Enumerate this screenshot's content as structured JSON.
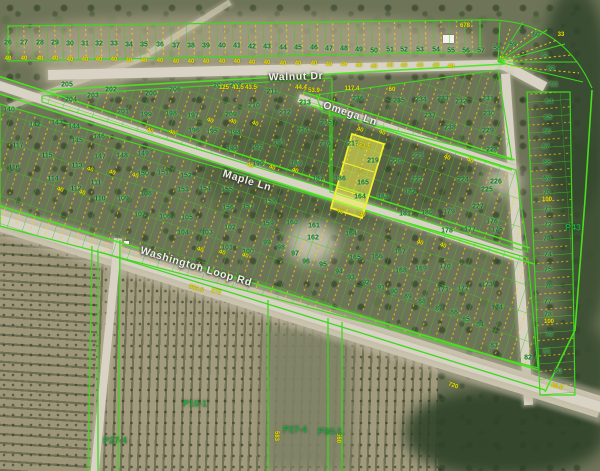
{
  "map": {
    "title": "Parcel map with aerial imagery",
    "colors": {
      "parcel_line_green": "#37cc1a",
      "survey_line_yellow": "#e4dc00",
      "lot_number_green": "#0b6e2c",
      "dimension_yellow": "#e9e100",
      "highlight_fill": "#f4ee3c",
      "road_tan": "#d8d3c4"
    },
    "highlight": {
      "parcel_labels": [
        "219",
        "165",
        "164"
      ],
      "fill": "#f4ee3c"
    },
    "streets": [
      [
        "Walnut Dr",
        296,
        77,
        -1.5
      ],
      [
        "Omega Ln",
        350,
        114,
        18.5
      ],
      [
        "Maple Ln",
        247,
        181,
        17
      ],
      [
        "Washington Loop Rd",
        196,
        267,
        16.5
      ]
    ],
    "parcels": [
      [
        "P10-1",
        195,
        404,
        0
      ],
      [
        "P27-4",
        295,
        430,
        0
      ],
      [
        "P34-1",
        330,
        432,
        0
      ],
      [
        "P27-4",
        115,
        441,
        0
      ],
      [
        "P43",
        573,
        228,
        0
      ]
    ],
    "lots": [
      [
        "26",
        8,
        43
      ],
      [
        "27",
        24,
        43
      ],
      [
        "28",
        40,
        43
      ],
      [
        "29",
        55,
        43
      ],
      [
        "30",
        70,
        44
      ],
      [
        "31",
        85,
        44
      ],
      [
        "32",
        99,
        44
      ],
      [
        "33",
        114,
        44
      ],
      [
        "34",
        129,
        45
      ],
      [
        "35",
        144,
        45
      ],
      [
        "36",
        160,
        45
      ],
      [
        "37",
        176,
        46
      ],
      [
        "38",
        191,
        46
      ],
      [
        "39",
        206,
        46
      ],
      [
        "40",
        222,
        46
      ],
      [
        "41",
        237,
        46
      ],
      [
        "42",
        252,
        47
      ],
      [
        "43",
        267,
        47
      ],
      [
        "44",
        283,
        48
      ],
      [
        "45",
        298,
        48
      ],
      [
        "46",
        314,
        48
      ],
      [
        "47",
        329,
        49
      ],
      [
        "48",
        344,
        49
      ],
      [
        "49",
        359,
        50
      ],
      [
        "50",
        374,
        51
      ],
      [
        "51",
        390,
        50
      ],
      [
        "52",
        404,
        50
      ],
      [
        "53",
        420,
        50
      ],
      [
        "54",
        436,
        50
      ],
      [
        "55",
        451,
        51
      ],
      [
        "56",
        466,
        51
      ],
      [
        "57",
        481,
        51
      ],
      [
        "58",
        497,
        49
      ],
      [
        "59",
        513,
        45
      ],
      [
        "60",
        536,
        35
      ],
      [
        "61",
        545,
        56
      ],
      [
        "62",
        551,
        69
      ],
      [
        "63",
        554,
        85
      ],
      [
        "64",
        549,
        102
      ],
      [
        "65",
        548,
        118
      ],
      [
        "66",
        547,
        132
      ],
      [
        "67",
        546,
        147
      ],
      [
        "68",
        547,
        163
      ],
      [
        "69",
        547,
        179
      ],
      [
        "70",
        547,
        193
      ],
      [
        "71",
        548,
        210
      ],
      [
        "72",
        548,
        225
      ],
      [
        "73",
        547,
        239
      ],
      [
        "74",
        548,
        255
      ],
      [
        "75",
        548,
        270
      ],
      [
        "76",
        549,
        286
      ],
      [
        "77",
        548,
        302
      ],
      [
        "78",
        548,
        315
      ],
      [
        "79",
        549,
        335
      ],
      [
        "80",
        558,
        372
      ],
      [
        "81",
        547,
        352
      ],
      [
        "82",
        528,
        358
      ],
      [
        "83",
        494,
        346
      ],
      [
        "84",
        480,
        325
      ],
      [
        "85",
        466,
        320
      ],
      [
        "86",
        454,
        313
      ],
      [
        "87",
        439,
        309
      ],
      [
        "88",
        422,
        302
      ],
      [
        "89",
        408,
        297
      ],
      [
        "90",
        394,
        292
      ],
      [
        "91",
        381,
        288
      ],
      [
        "92",
        366,
        283
      ],
      [
        "93",
        351,
        278
      ],
      [
        "94",
        339,
        272
      ],
      [
        "95",
        323,
        265
      ],
      [
        "96",
        306,
        262
      ],
      [
        "97",
        295,
        254
      ],
      [
        "98",
        281,
        248
      ],
      [
        "99",
        267,
        243
      ],
      [
        "100",
        248,
        252
      ],
      [
        "101",
        227,
        248
      ],
      [
        "102",
        230,
        228
      ],
      [
        "103",
        207,
        233
      ],
      [
        "104",
        183,
        233
      ],
      [
        "105",
        187,
        218
      ],
      [
        "106",
        165,
        217
      ],
      [
        "107",
        140,
        215
      ],
      [
        "108",
        146,
        194
      ],
      [
        "109",
        123,
        199
      ],
      [
        "110",
        100,
        199
      ],
      [
        "111",
        96,
        183
      ],
      [
        "112",
        76,
        189
      ],
      [
        "113",
        77,
        166
      ],
      [
        "114",
        53,
        179
      ],
      [
        "115",
        47,
        156
      ],
      [
        "116",
        14,
        168
      ],
      [
        "117",
        18,
        146
      ],
      [
        "140",
        9,
        110
      ],
      [
        "142",
        35,
        125
      ],
      [
        "143",
        57,
        123
      ],
      [
        "144",
        74,
        127
      ],
      [
        "145",
        77,
        141
      ],
      [
        "146",
        99,
        137
      ],
      [
        "147",
        100,
        157
      ],
      [
        "148",
        122,
        156
      ],
      [
        "149",
        143,
        154
      ],
      [
        "150",
        143,
        174
      ],
      [
        "151",
        163,
        173
      ],
      [
        "152",
        186,
        176
      ],
      [
        "153",
        183,
        190
      ],
      [
        "154",
        205,
        189
      ],
      [
        "155",
        227,
        190
      ],
      [
        "156",
        228,
        208
      ],
      [
        "157",
        248,
        207
      ],
      [
        "158",
        270,
        202
      ],
      [
        "159",
        268,
        224
      ],
      [
        "160",
        292,
        223
      ],
      [
        "161",
        314,
        226
      ],
      [
        "162",
        313,
        238
      ],
      [
        "164",
        351,
        234
      ],
      [
        "165",
        355,
        258
      ],
      [
        "166",
        377,
        257
      ],
      [
        "167",
        400,
        252
      ],
      [
        "168",
        401,
        271
      ],
      [
        "169",
        421,
        269
      ],
      [
        "170",
        445,
        267
      ],
      [
        "171",
        443,
        290
      ],
      [
        "172",
        463,
        289
      ],
      [
        "173",
        487,
        285
      ],
      [
        "174",
        497,
        308
      ],
      [
        "175",
        497,
        230
      ],
      [
        "176",
        492,
        222
      ],
      [
        "177",
        470,
        230
      ],
      [
        "178",
        447,
        231
      ],
      [
        "179",
        449,
        212
      ],
      [
        "180",
        427,
        213
      ],
      [
        "181",
        405,
        214
      ],
      [
        "182",
        410,
        192
      ],
      [
        "183",
        383,
        197
      ],
      [
        "186",
        340,
        179
      ],
      [
        "187",
        318,
        179
      ],
      [
        "189",
        296,
        164
      ],
      [
        "190",
        258,
        164
      ],
      [
        "191",
        279,
        143
      ],
      [
        "192",
        257,
        148
      ],
      [
        "193",
        232,
        149
      ],
      [
        "194",
        235,
        133
      ],
      [
        "195",
        212,
        132
      ],
      [
        "196",
        194,
        131
      ],
      [
        "197",
        193,
        116
      ],
      [
        "198",
        171,
        114
      ],
      [
        "199",
        146,
        115
      ],
      [
        "200",
        151,
        94
      ],
      [
        "201",
        123,
        112
      ],
      [
        "202",
        111,
        90
      ],
      [
        "203",
        93,
        96
      ],
      [
        "204",
        71,
        100
      ],
      [
        "205",
        67,
        85
      ],
      [
        "206",
        175,
        90
      ],
      [
        "207",
        219,
        86
      ],
      [
        "208",
        236,
        85
      ],
      [
        "209",
        231,
        115
      ],
      [
        "210",
        254,
        106
      ],
      [
        "211",
        272,
        92
      ],
      [
        "212",
        285,
        113
      ],
      [
        "213",
        305,
        103
      ],
      [
        "214",
        303,
        131
      ],
      [
        "215",
        326,
        123
      ],
      [
        "216",
        325,
        144
      ],
      [
        "217",
        353,
        144
      ],
      [
        "219",
        373,
        161
      ],
      [
        "165",
        363,
        183
      ],
      [
        "164",
        360,
        197
      ],
      [
        "220",
        396,
        162
      ],
      [
        "221",
        418,
        156
      ],
      [
        "222",
        417,
        180
      ],
      [
        "224",
        463,
        180
      ],
      [
        "225",
        487,
        190
      ],
      [
        "226",
        496,
        182
      ],
      [
        "227",
        478,
        207
      ],
      [
        "228",
        492,
        150
      ],
      [
        "229",
        488,
        131
      ],
      [
        "230",
        489,
        114
      ],
      [
        "231",
        488,
        99
      ],
      [
        "232",
        461,
        102
      ],
      [
        "233",
        443,
        99
      ],
      [
        "234",
        421,
        100
      ],
      [
        "235",
        399,
        101
      ],
      [
        "236",
        358,
        99
      ],
      [
        "237",
        430,
        116
      ],
      [
        "238",
        450,
        128
      ]
    ],
    "dims": [
      [
        "40",
        8,
        59
      ],
      [
        "40",
        24,
        59
      ],
      [
        "40",
        40,
        59
      ],
      [
        "40",
        55,
        59
      ],
      [
        "40",
        70,
        60
      ],
      [
        "40",
        85,
        60
      ],
      [
        "40",
        99,
        60
      ],
      [
        "40",
        114,
        60
      ],
      [
        "40",
        129,
        61
      ],
      [
        "40",
        144,
        61
      ],
      [
        "40",
        160,
        61
      ],
      [
        "40",
        176,
        62
      ],
      [
        "40",
        191,
        62
      ],
      [
        "40",
        206,
        62
      ],
      [
        "40",
        222,
        62
      ],
      [
        "40",
        237,
        62
      ],
      [
        "40",
        252,
        63
      ],
      [
        "40",
        267,
        63
      ],
      [
        "40",
        283,
        64
      ],
      [
        "40",
        298,
        64
      ],
      [
        "40",
        314,
        64
      ],
      [
        "40",
        329,
        65
      ],
      [
        "40",
        344,
        65
      ],
      [
        "40",
        359,
        66
      ],
      [
        "40",
        374,
        67
      ],
      [
        "40",
        390,
        66
      ],
      [
        "40",
        404,
        66
      ],
      [
        "40",
        420,
        66
      ],
      [
        "40",
        436,
        66
      ],
      [
        "40",
        451,
        67
      ],
      [
        "678",
        465,
        26
      ],
      [
        "100",
        547,
        200
      ],
      [
        "100",
        549,
        322
      ],
      [
        "121.5",
        363,
        146,
        18
      ],
      [
        "720",
        453,
        386,
        20
      ],
      [
        "85.8",
        557,
        387,
        15
      ],
      [
        "382.5",
        196,
        289,
        17
      ],
      [
        "273",
        216,
        292,
        17
      ],
      [
        "117.4",
        352,
        89
      ],
      [
        "60",
        392,
        90
      ],
      [
        "44.4",
        301,
        88
      ],
      [
        "53.9",
        314,
        91
      ],
      [
        "125",
        224,
        88
      ],
      [
        "41.5",
        238,
        88
      ],
      [
        "43.5",
        251,
        88
      ],
      [
        "583",
        276,
        436,
        90
      ],
      [
        "560",
        338,
        438,
        90
      ],
      [
        "33",
        561,
        35
      ],
      [
        "40",
        210,
        121,
        18
      ],
      [
        "40",
        233,
        122,
        18
      ],
      [
        "40",
        255,
        124,
        18
      ],
      [
        "40",
        150,
        131,
        18
      ],
      [
        "40",
        172,
        133,
        18
      ],
      [
        "40",
        250,
        166,
        18
      ],
      [
        "40",
        272,
        168,
        18
      ],
      [
        "40",
        295,
        171,
        18
      ],
      [
        "40",
        340,
        212,
        18
      ],
      [
        "40",
        362,
        215,
        18
      ],
      [
        "40",
        420,
        243,
        18
      ],
      [
        "40",
        443,
        246,
        18
      ],
      [
        "40",
        470,
        161,
        18
      ],
      [
        "40",
        447,
        158,
        18
      ],
      [
        "40",
        360,
        130,
        18
      ],
      [
        "40",
        382,
        133,
        18
      ],
      [
        "40",
        90,
        170,
        17
      ],
      [
        "40",
        112,
        173,
        17
      ],
      [
        "40",
        135,
        176,
        17
      ],
      [
        "40",
        60,
        190,
        17
      ],
      [
        "40",
        82,
        193,
        17
      ],
      [
        "40",
        200,
        250,
        17
      ],
      [
        "40",
        222,
        253,
        17
      ],
      [
        "40",
        245,
        256,
        17
      ]
    ]
  }
}
